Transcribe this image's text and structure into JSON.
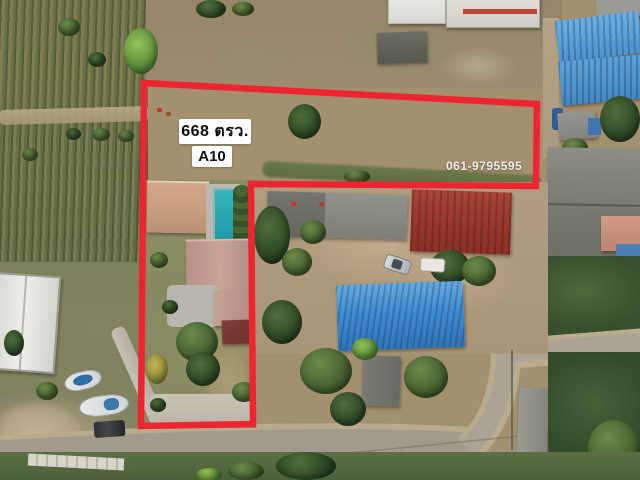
{
  "overlay": {
    "area_label": "668 ตรว.",
    "plot_label": "A10",
    "phone": "061-9795595",
    "colors": {
      "boundary": "#ee2531",
      "label_bg": "#ffffff",
      "label_text": "#0d0d0d",
      "phone_text": "#f2f0ea"
    }
  }
}
